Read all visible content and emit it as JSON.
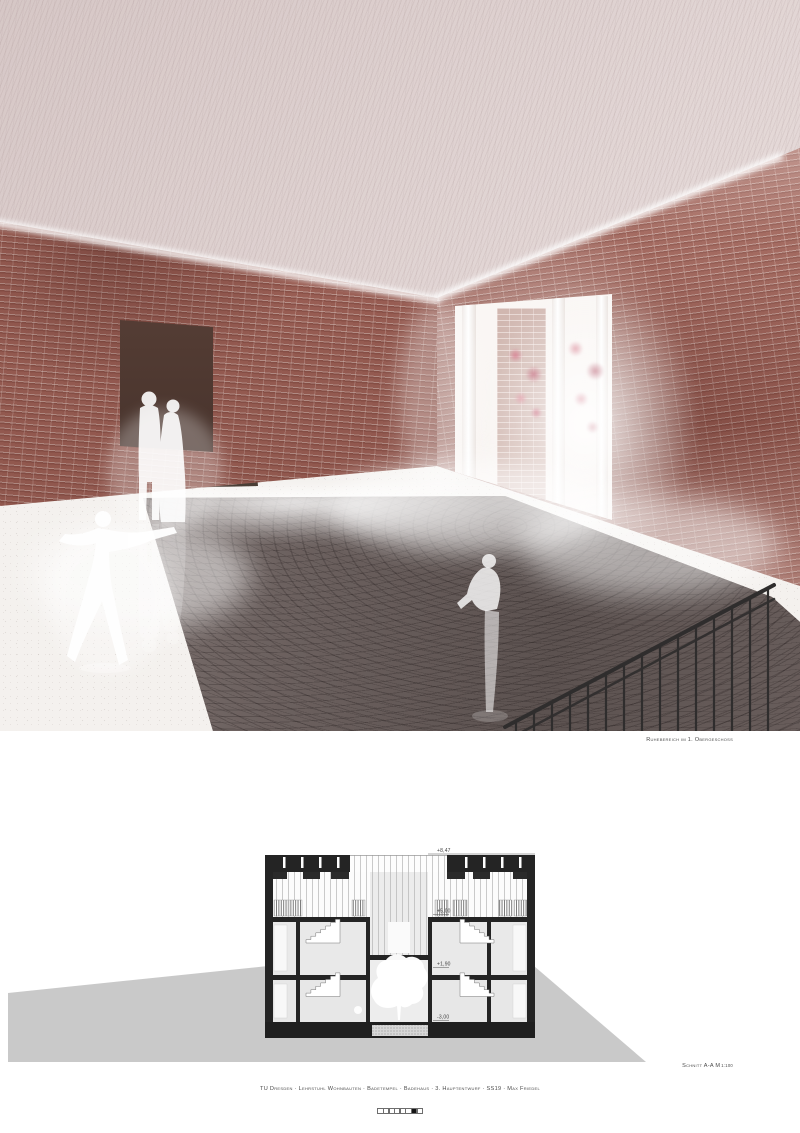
{
  "rendering": {
    "caption": "Ruhebereich im 1. Obergeschoss",
    "colors": {
      "brick": "#9a5e54",
      "ceiling": "#dccfce",
      "floor": "#f2efec",
      "pool_water": "#6e6361",
      "foliage_pink": "#cf6d80",
      "silhouette": "#ffffff"
    }
  },
  "section": {
    "caption_main": "Schnitt A-A M",
    "caption_scale": "1:100",
    "levels": [
      {
        "label": "+8,47"
      },
      {
        "label": "+5,00"
      },
      {
        "label": "+1,90"
      },
      {
        "label": "-3,00"
      }
    ],
    "colors": {
      "poche_black": "#242424",
      "terrain_gray": "#c9c9c9"
    }
  },
  "footer": {
    "project_line": "TU Dresden · Lehrstuhl Wohnbauten · Badetempel · Badehaus · 3. Hauptentwurf · SS19 · Max Friedel",
    "scale_bar": {
      "segments": 8,
      "filled_segment": 7
    }
  }
}
